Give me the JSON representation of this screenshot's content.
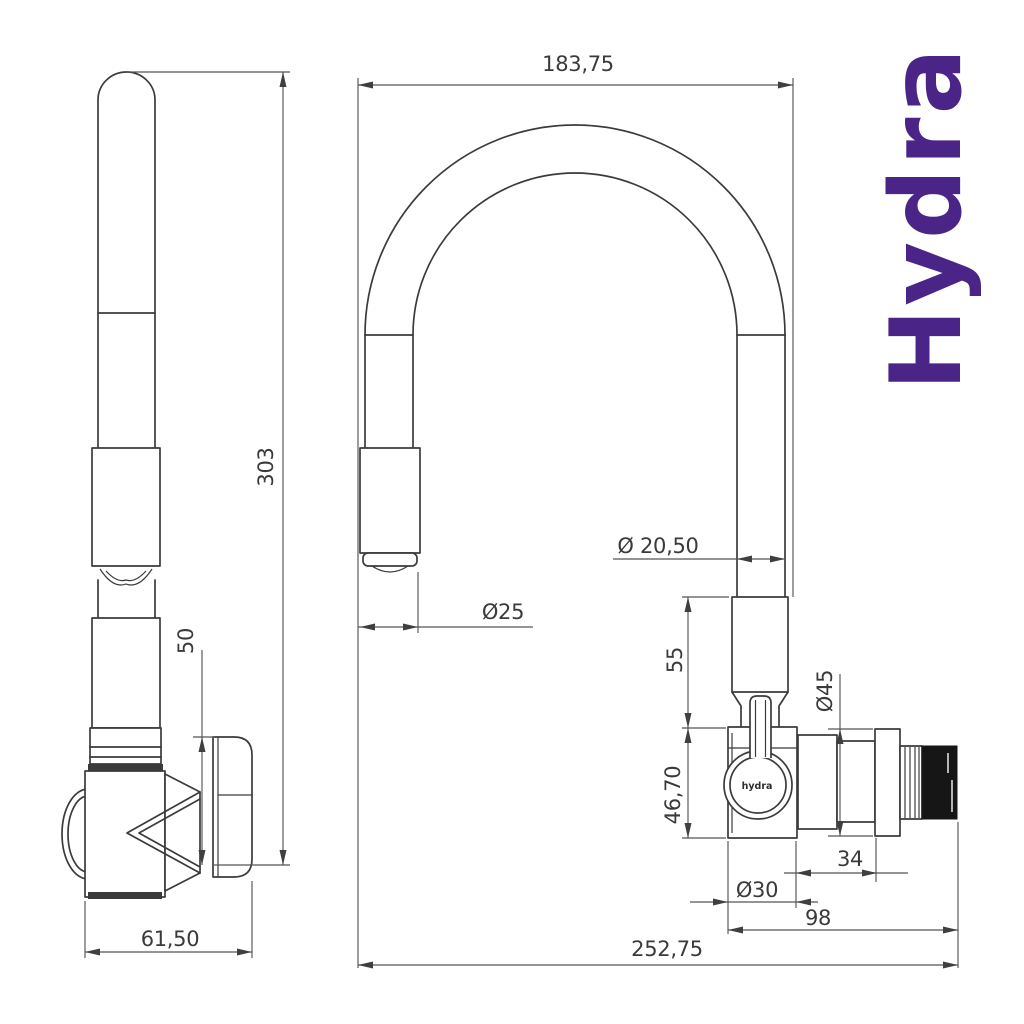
{
  "drawing": {
    "background": "#ffffff",
    "line_color": "#3b3b3b",
    "dimension_line_color": "#555555"
  },
  "logo": {
    "text": "Hydra",
    "color": "#4a2487"
  },
  "side_view": {
    "dims": {
      "total_height": "303",
      "body_section_height": "50",
      "base_width": "61,50"
    }
  },
  "front_view": {
    "knob_label": "hydra",
    "dims": {
      "spout_reach": "183,75",
      "spray_head_diameter": "Ø25",
      "hose_diameter": "Ø 20,50",
      "upper_body_height": "55",
      "valve_body_height": "46,70",
      "flange_diameter": "Ø45",
      "connector_length": "34",
      "valve_body_diameter": "Ø30",
      "outlet_length": "98",
      "total_reach": "252,75"
    }
  }
}
